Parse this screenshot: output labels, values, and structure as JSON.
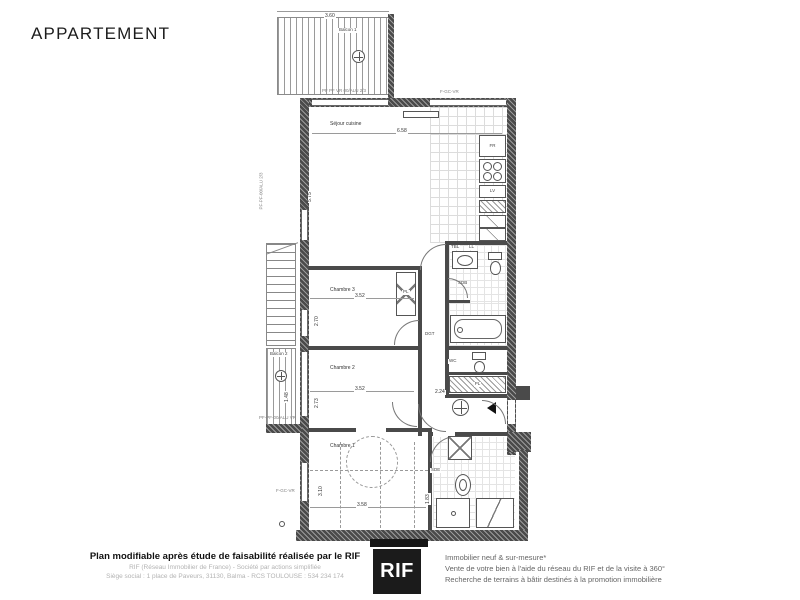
{
  "title": "APPARTEMENT",
  "plan": {
    "rooms": {
      "balcon1": "Balcon 1",
      "balcon2": "Balcon 2",
      "sejour": "Séjour cuisine",
      "chambre3": "Chambre 3",
      "chambre2": "Chambre 2",
      "chambre1": "Chambre 1",
      "sdb": "SDB",
      "wc": "WC",
      "dgt": "DGT",
      "sde": "SDE",
      "pl_chambre3": "PL",
      "pl_couloir": "PL"
    },
    "appliances": {
      "fr": "FR",
      "lv": "LV",
      "tbl": "TBL",
      "ll": "LL"
    },
    "window_tags": {
      "top_balcony": "PF PF VR 00/ALU 2/3",
      "top_right": "F-GC-VR",
      "left_sejour": "PF-PF-00/ALU 2/3",
      "left_balcon2": "PF-PF-00/ALU VR",
      "bottom_left": "F-GC-VR"
    },
    "dims": {
      "balcon1_w": "3.60",
      "sejour_w": "6.58",
      "sejour_h": "5.75",
      "ch3_w": "3.52",
      "ch3_h": "2.70",
      "ch2_w": "3.52",
      "ch2_h": "2.73",
      "ch1_w": "3.58",
      "ch1_h": "3.10",
      "hall_w": "2.24",
      "balcon2_h": "1.48",
      "sde_h": "1.83"
    }
  },
  "footer": {
    "left": {
      "line1": "Plan modifiable après étude de faisabilité réalisée par le RIF",
      "line2": "RIF (Réseau Immobilier de France) - Société par actions simplifiée",
      "line3": "Siège social : 1 place de Paveurs, 31130, Balma - RCS TOULOUSE : 534 234 174"
    },
    "logo": "RIF",
    "right": {
      "line1": "Immobilier neuf & sur-mesure*",
      "line2": "Vente de votre bien à l'aide du réseau du RIF et de la visite à 360°",
      "line3": "Recherche de terrains à bâtir destinés à la promotion immobilière"
    }
  }
}
